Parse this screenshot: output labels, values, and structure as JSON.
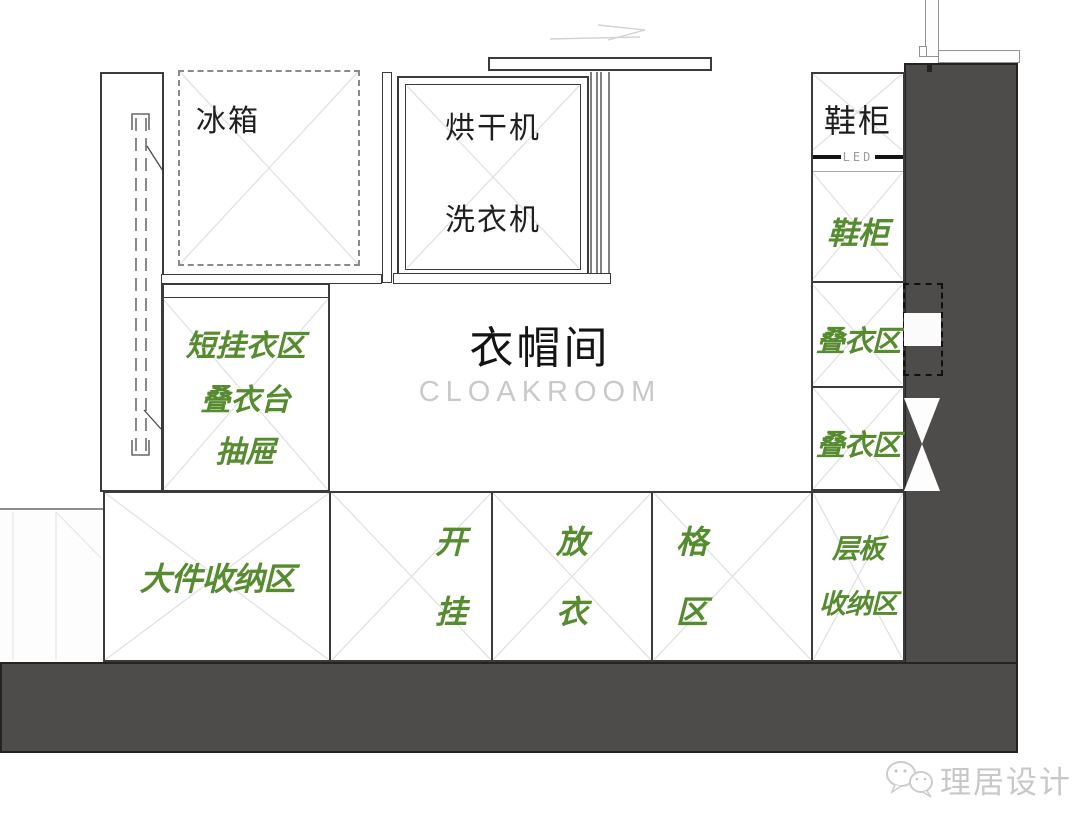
{
  "room": {
    "title_zh": "衣帽间",
    "title_en": "CLOAKROOM"
  },
  "appliances": {
    "fridge": "冰箱",
    "dryer": "烘干机",
    "washer": "洗衣机"
  },
  "right_column": {
    "shoe_cabinet_top": "鞋柜",
    "led_label": "LED",
    "shoe_cabinet_lower": "鞋柜",
    "fold_area_1": "叠衣区",
    "fold_area_2": "叠衣区"
  },
  "left_zone": {
    "lines": [
      "短挂衣区",
      "叠衣台",
      "抽屉"
    ]
  },
  "bottom_row": {
    "bulk_storage": "大件收纳区",
    "open_hang": [
      "开",
      "挂"
    ],
    "put_clothes": [
      "放",
      "衣"
    ],
    "grid_zone": [
      "格",
      "区"
    ],
    "shelf_storage": [
      "层板",
      "收纳区"
    ]
  },
  "watermark": {
    "brand": "理居设计"
  },
  "colors": {
    "accent_green": "#568B2F",
    "wall_gray": "#4E4B4B",
    "text_black": "#1F1F1F",
    "watermark_gray": "#C8C8C8"
  }
}
